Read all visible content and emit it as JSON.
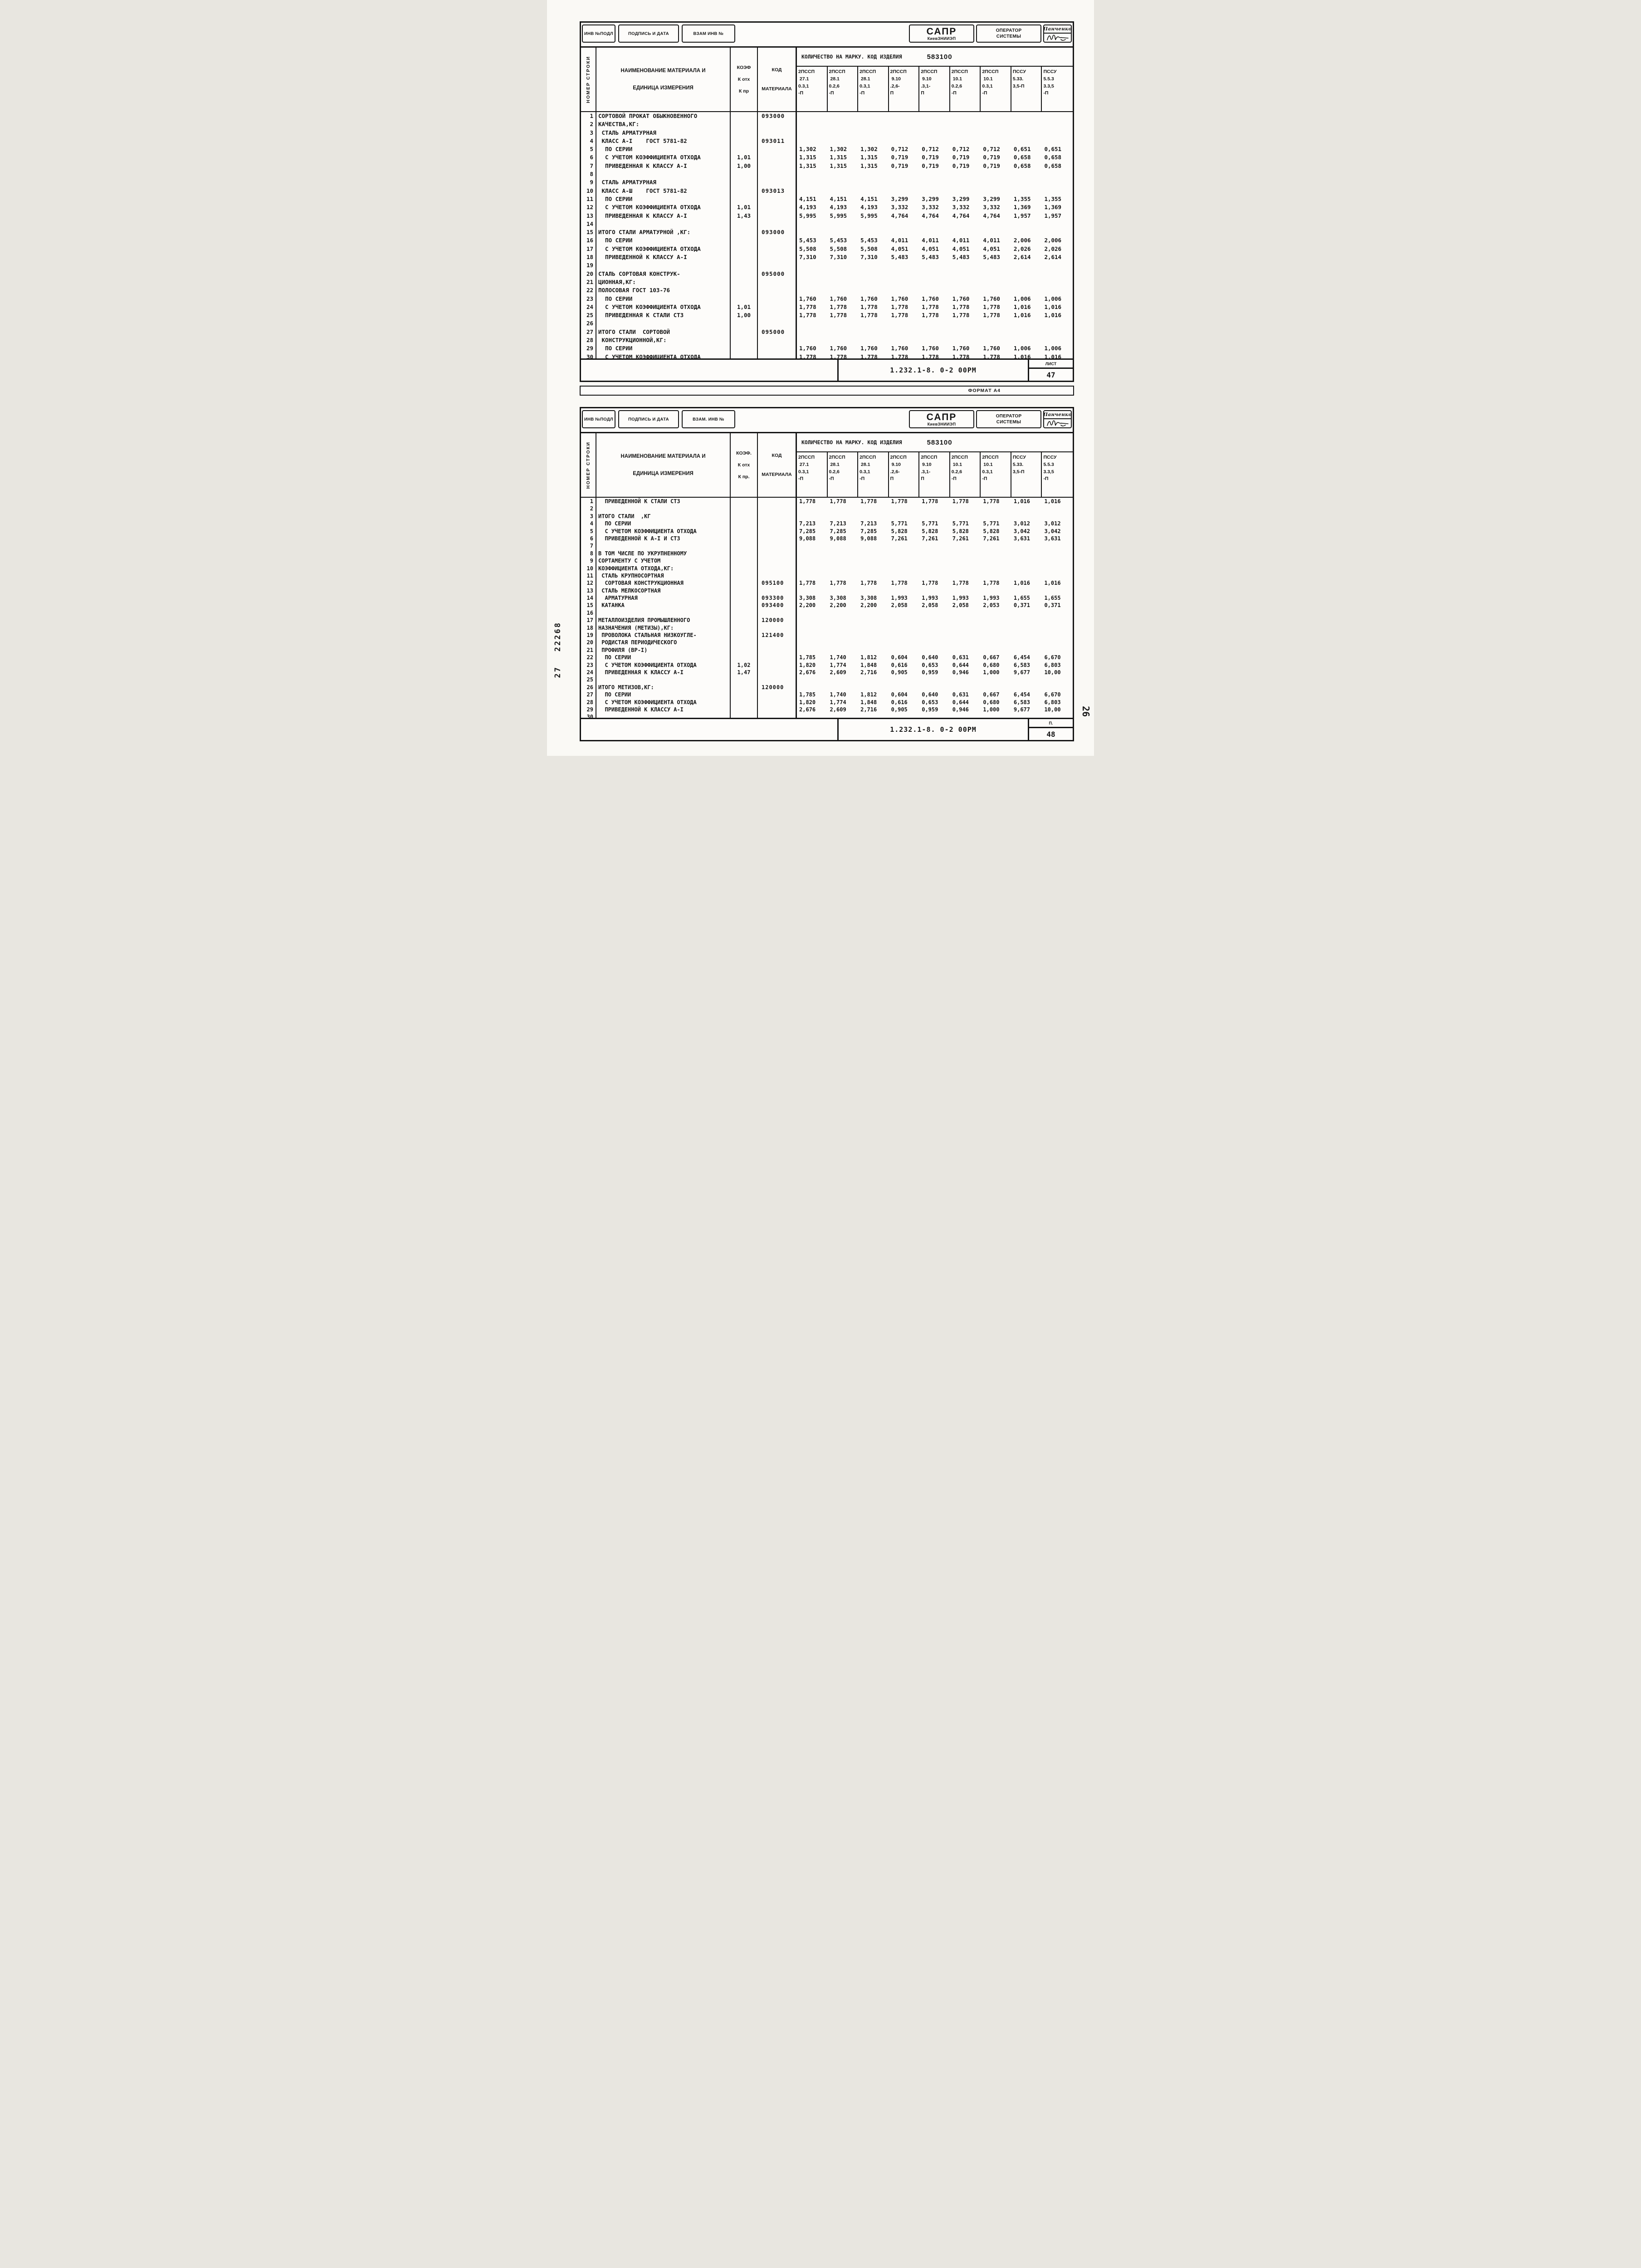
{
  "page": {
    "format_label": "ФОРМАТ А4",
    "margin_left_top": "22268",
    "margin_left_bottom": "27",
    "side_page_number": "26"
  },
  "sheets": [
    {
      "stamp_left": [
        "ИНВ №ПОДЛ",
        "ПОДПИСЬ И ДАТА",
        "ВЗАМ ИНВ №"
      ],
      "org": "САПР",
      "org_sub": "КиевЗНИИЭП",
      "operator_line1": "ОПЕРАТОР",
      "operator_line2": "СИСТЕМЫ",
      "operator_name": "Панченко",
      "row_header_vertical": "НОМЕР СТРОКИ",
      "name_header_1": "НАИМЕНОВАНИЕ  МАТЕРИАЛА  И",
      "name_header_2": "ЕДИНИЦА ИЗМЕРЕНИЯ",
      "coef_header": "КОЭФ",
      "coef_sub1": "К отх",
      "coef_sub2": "К пр",
      "code_header_1": "КОД",
      "code_header_2": "МАТЕРИАЛА",
      "qty_header": "КОЛИЧЕСТВО НА МАРКУ. КОД ИЗДЕЛИЯ",
      "product_code": "583100",
      "columns": [
        [
          "2ПССП",
          " 27.1",
          "0.3,1",
          "-П"
        ],
        [
          "2ПССП",
          " 28.1",
          "0.2,6",
          "-П"
        ],
        [
          "2ПССП",
          " 28.1",
          "0.3,1",
          "-П"
        ],
        [
          "2ПССП",
          " 9.10",
          ".2,6-",
          "П"
        ],
        [
          "2ПССП",
          " 9.10",
          ".3,1-",
          "П"
        ],
        [
          "2ПССП",
          " 10.1",
          "0.2,6",
          "-П"
        ],
        [
          "2ПССП",
          " 10.1",
          "0.3,1",
          "-П"
        ],
        [
          "ПССУ",
          "5.33.",
          "3,5-П",
          ""
        ],
        [
          "ПССУ",
          "5.5.3",
          "3.3,5",
          "-П"
        ]
      ],
      "rows": [
        {
          "n": "1",
          "name": "СОРТОВОЙ ПРОКАТ ОБЫКНОВЕННОГО",
          "coef": "",
          "code": "093000",
          "v": []
        },
        {
          "n": "2",
          "name": "КАЧЕСТВА,КГ:",
          "coef": "",
          "code": "",
          "v": []
        },
        {
          "n": "3",
          "name": " СТАЛЬ АРМАТУРНАЯ",
          "coef": "",
          "code": "",
          "v": []
        },
        {
          "n": "4",
          "name": " КЛАСС А-I    ГОСТ 5781-82",
          "coef": "",
          "code": "093011",
          "v": []
        },
        {
          "n": "5",
          "name": "  ПО СЕРИИ",
          "coef": "",
          "code": "",
          "v": [
            "1,302",
            "1,302",
            "1,302",
            "0,712",
            "0,712",
            "0,712",
            "0,712",
            "0,651",
            "0,651"
          ]
        },
        {
          "n": "6",
          "name": "  С УЧЕТОМ КОЭФФИЦИЕНТА ОТХОДА",
          "coef": "1,01",
          "code": "",
          "v": [
            "1,315",
            "1,315",
            "1,315",
            "0,719",
            "0,719",
            "0,719",
            "0,719",
            "0,658",
            "0,658"
          ]
        },
        {
          "n": "7",
          "name": "  ПРИВЕДЕННАЯ К КЛАССУ А-I",
          "coef": "1,00",
          "code": "",
          "v": [
            "1,315",
            "1,315",
            "1,315",
            "0,719",
            "0,719",
            "0,719",
            "0,719",
            "0,658",
            "0,658"
          ]
        },
        {
          "n": "8",
          "name": "",
          "coef": "",
          "code": "",
          "v": []
        },
        {
          "n": "9",
          "name": " СТАЛЬ АРМАТУРНАЯ",
          "coef": "",
          "code": "",
          "v": []
        },
        {
          "n": "10",
          "name": " КЛАСС А-Ш    ГОСТ 5781-82",
          "coef": "",
          "code": "093013",
          "v": []
        },
        {
          "n": "11",
          "name": "  ПО СЕРИИ",
          "coef": "",
          "code": "",
          "v": [
            "4,151",
            "4,151",
            "4,151",
            "3,299",
            "3,299",
            "3,299",
            "3,299",
            "1,355",
            "1,355"
          ]
        },
        {
          "n": "12",
          "name": "  С УЧЕТОМ КОЭФФИЦИЕНТА ОТХОДА",
          "coef": "1,01",
          "code": "",
          "v": [
            "4,193",
            "4,193",
            "4,193",
            "3,332",
            "3,332",
            "3,332",
            "3,332",
            "1,369",
            "1,369"
          ]
        },
        {
          "n": "13",
          "name": "  ПРИВЕДЕННАЯ К КЛАССУ А-I",
          "coef": "1,43",
          "code": "",
          "v": [
            "5,995",
            "5,995",
            "5,995",
            "4,764",
            "4,764",
            "4,764",
            "4,764",
            "1,957",
            "1,957"
          ]
        },
        {
          "n": "14",
          "name": "",
          "coef": "",
          "code": "",
          "v": []
        },
        {
          "n": "15",
          "name": "ИТОГО СТАЛИ АРМАТУРНОЙ ,КГ:",
          "coef": "",
          "code": "093000",
          "v": []
        },
        {
          "n": "16",
          "name": "  ПО СЕРИИ",
          "coef": "",
          "code": "",
          "v": [
            "5,453",
            "5,453",
            "5,453",
            "4,011",
            "4,011",
            "4,011",
            "4,011",
            "2,006",
            "2,006"
          ]
        },
        {
          "n": "17",
          "name": "  С УЧЕТОМ КОЭФФИЦИЕНТА ОТХОДА",
          "coef": "",
          "code": "",
          "v": [
            "5,508",
            "5,508",
            "5,508",
            "4,051",
            "4,051",
            "4,051",
            "4,051",
            "2,026",
            "2,026"
          ]
        },
        {
          "n": "18",
          "name": "  ПРИВЕДЕННОЙ К КЛАССУ А-I",
          "coef": "",
          "code": "",
          "v": [
            "7,310",
            "7,310",
            "7,310",
            "5,483",
            "5,483",
            "5,483",
            "5,483",
            "2,614",
            "2,614"
          ]
        },
        {
          "n": "19",
          "name": "",
          "coef": "",
          "code": "",
          "v": []
        },
        {
          "n": "20",
          "name": "СТАЛЬ СОРТОВАЯ КОНСТРУК-",
          "coef": "",
          "code": "095000",
          "v": []
        },
        {
          "n": "21",
          "name": "ЦИОННАЯ,КГ:",
          "coef": "",
          "code": "",
          "v": []
        },
        {
          "n": "22",
          "name": "ПОЛОСОВАЯ ГОСТ 103-76",
          "coef": "",
          "code": "",
          "v": []
        },
        {
          "n": "23",
          "name": "  ПО СЕРИИ",
          "coef": "",
          "code": "",
          "v": [
            "1,760",
            "1,760",
            "1,760",
            "1,760",
            "1,760",
            "1,760",
            "1,760",
            "1,006",
            "1,006"
          ]
        },
        {
          "n": "24",
          "name": "  С УЧЕТОМ КОЭФФИЦИЕНТА ОТХОДА",
          "coef": "1,01",
          "code": "",
          "v": [
            "1,778",
            "1,778",
            "1,778",
            "1,778",
            "1,778",
            "1,778",
            "1,778",
            "1,016",
            "1,016"
          ]
        },
        {
          "n": "25",
          "name": "  ПРИВЕДЕННАЯ К СТАЛИ СТ3",
          "coef": "1,00",
          "code": "",
          "v": [
            "1,778",
            "1,778",
            "1,778",
            "1,778",
            "1,778",
            "1,778",
            "1,778",
            "1,016",
            "1,016"
          ]
        },
        {
          "n": "26",
          "name": "",
          "coef": "",
          "code": "",
          "v": []
        },
        {
          "n": "27",
          "name": "ИТОГО СТАЛИ  СОРТОВОЙ",
          "coef": "",
          "code": "095000",
          "v": []
        },
        {
          "n": "28",
          "name": " КОНСТРУКЦИОННОЙ,КГ:",
          "coef": "",
          "code": "",
          "v": []
        },
        {
          "n": "29",
          "name": "  ПО СЕРИИ",
          "coef": "",
          "code": "",
          "v": [
            "1,760",
            "1,760",
            "1,760",
            "1,760",
            "1,760",
            "1,760",
            "1,760",
            "1,006",
            "1,006"
          ]
        },
        {
          "n": "30",
          "name": "  С УЧЕТОМ КОЭФФИЦИЕНТА ОТХОДА",
          "coef": "",
          "code": "",
          "v": [
            "1,778",
            "1,778",
            "1,778",
            "1,778",
            "1,778",
            "1,778",
            "1,778",
            "1,016",
            "1,016"
          ]
        }
      ],
      "footer_doc": "1.232.1-8.  0-2 00РМ",
      "footer_sheet_label": "ЛИСТ",
      "footer_sheet_no": "47"
    },
    {
      "stamp_left": [
        "ИНВ №ПОДЛ",
        "ПОДПИСЬ И ДАТА",
        "ВЗАМ. ИНВ №"
      ],
      "org": "САПР",
      "org_sub": "КиевЗНИИЭП",
      "operator_line1": "ОПЕРАТОР",
      "operator_line2": "СИСТЕМЫ",
      "operator_name": "Панченко",
      "row_header_vertical": "НОМЕР СТРОКИ",
      "name_header_1": "НАИМЕНОВАНИЕ  МАТЕРИАЛА  И",
      "name_header_2": "ЕДИНИЦА ИЗМЕРЕНИЯ",
      "coef_header": "КОЭФ.",
      "coef_sub1": "К отх",
      "coef_sub2": "К пр.",
      "code_header_1": "КОД",
      "code_header_2": "МАТЕРИАЛА",
      "qty_header": "КОЛИЧЕСТВО НА МАРКУ. КОД ИЗДЕЛИЯ",
      "product_code": "583100",
      "columns": [
        [
          "2ПССП",
          " 27.1",
          "0.3,1",
          "-П"
        ],
        [
          "2ПССП",
          " 28.1",
          "0.2,6",
          "-П"
        ],
        [
          "2ПССП",
          " 28.1",
          "0.3,1",
          "-П"
        ],
        [
          "2ПССП",
          " 9.10",
          ".2,6-",
          "П"
        ],
        [
          "2ПССП",
          " 9.10",
          ".3,1-",
          "П"
        ],
        [
          "2ПССП",
          " 10.1",
          "0.2,6",
          "-П"
        ],
        [
          "2ПССП",
          " 10.1",
          "0.3,1",
          "-П"
        ],
        [
          "ПССУ",
          "5.33.",
          "3,5-П",
          ""
        ],
        [
          "ПССУ",
          "5.5.3",
          "3.3,5",
          "-П"
        ]
      ],
      "rows": [
        {
          "n": "1",
          "name": "  ПРИВЕДЕННОЙ К СТАЛИ СТ3",
          "coef": "",
          "code": "",
          "v": [
            "1,778",
            "1,778",
            "1,778",
            "1,778",
            "1,778",
            "1,778",
            "1,778",
            "1,016",
            "1,016"
          ]
        },
        {
          "n": "2",
          "name": "",
          "coef": "",
          "code": "",
          "v": []
        },
        {
          "n": "3",
          "name": "ИТОГО СТАЛИ  ,КГ",
          "coef": "",
          "code": "",
          "v": []
        },
        {
          "n": "4",
          "name": "  ПО СЕРИИ",
          "coef": "",
          "code": "",
          "v": [
            "7,213",
            "7,213",
            "7,213",
            "5,771",
            "5,771",
            "5,771",
            "5,771",
            "3,012",
            "3,012"
          ]
        },
        {
          "n": "5",
          "name": "  С УЧЕТОМ КОЭФФИЦИЕНТА ОТХОДА",
          "coef": "",
          "code": "",
          "v": [
            "7,285",
            "7,285",
            "7,285",
            "5,828",
            "5,828",
            "5,828",
            "5,828",
            "3,042",
            "3,042"
          ]
        },
        {
          "n": "6",
          "name": "  ПРИВЕДЕННОЙ К А-I И СТ3",
          "coef": "",
          "code": "",
          "v": [
            "9,088",
            "9,088",
            "9,088",
            "7,261",
            "7,261",
            "7,261",
            "7,261",
            "3,631",
            "3,631"
          ]
        },
        {
          "n": "7",
          "name": "",
          "coef": "",
          "code": "",
          "v": []
        },
        {
          "n": "8",
          "name": "В ТОМ ЧИСЛЕ ПО УКРУПНЕННОМУ",
          "coef": "",
          "code": "",
          "v": []
        },
        {
          "n": "9",
          "name": "СОРТАМЕНТУ С УЧЕТОМ",
          "coef": "",
          "code": "",
          "v": []
        },
        {
          "n": "10",
          "name": "КОЭФФИЦИЕНТА ОТХОДА,КГ:",
          "coef": "",
          "code": "",
          "v": []
        },
        {
          "n": "11",
          "name": " СТАЛЬ КРУПНОСОРТНАЯ",
          "coef": "",
          "code": "",
          "v": []
        },
        {
          "n": "12",
          "name": "  СОРТОВАЯ КОНСТРУКЦИОННАЯ",
          "coef": "",
          "code": "095100",
          "v": [
            "1,778",
            "1,778",
            "1,778",
            "1,778",
            "1,778",
            "1,778",
            "1,778",
            "1,016",
            "1,016"
          ]
        },
        {
          "n": "13",
          "name": " СТАЛЬ МЕЛКОСОРТНАЯ",
          "coef": "",
          "code": "",
          "v": []
        },
        {
          "n": "14",
          "name": "  АРМАТУРНАЯ",
          "coef": "",
          "code": "093300",
          "v": [
            "3,308",
            "3,308",
            "3,308",
            "1,993",
            "1,993",
            "1,993",
            "1,993",
            "1,655",
            "1,655"
          ]
        },
        {
          "n": "15",
          "name": " КАТАНКА",
          "coef": "",
          "code": "093400",
          "v": [
            "2,200",
            "2,200",
            "2,200",
            "2,058",
            "2,058",
            "2,058",
            "2,053",
            "0,371",
            "0,371"
          ]
        },
        {
          "n": "16",
          "name": "",
          "coef": "",
          "code": "",
          "v": []
        },
        {
          "n": "17",
          "name": "МЕТАЛЛОИЗДЕЛИЯ ПРОМЫШЛЕННОГО",
          "coef": "",
          "code": "120000",
          "v": []
        },
        {
          "n": "18",
          "name": "НАЗНАЧЕНИЯ (МЕТИЗЫ),КГ:",
          "coef": "",
          "code": "",
          "v": []
        },
        {
          "n": "19",
          "name": " ПРОВОЛОКА СТАЛЬНАЯ НИЗКОУГЛЕ-",
          "coef": "",
          "code": "121400",
          "v": []
        },
        {
          "n": "20",
          "name": " РОДИСТАЯ ПЕРИОДИЧЕСКОГО",
          "coef": "",
          "code": "",
          "v": []
        },
        {
          "n": "21",
          "name": " ПРОФИЛЯ (ВР-I)",
          "coef": "",
          "code": "",
          "v": []
        },
        {
          "n": "22",
          "name": "  ПО СЕРИИ",
          "coef": "",
          "code": "",
          "v": [
            "1,785",
            "1,740",
            "1,812",
            "0,604",
            "0,640",
            "0,631",
            "0,667",
            "6,454",
            "6,670"
          ]
        },
        {
          "n": "23",
          "name": "  С УЧЕТОМ КОЭФФИЦИЕНТА ОТХОДА",
          "coef": "1,02",
          "code": "",
          "v": [
            "1,820",
            "1,774",
            "1,848",
            "0,616",
            "0,653",
            "0,644",
            "0,680",
            "6,583",
            "6,803"
          ]
        },
        {
          "n": "24",
          "name": "  ПРИВЕДЕННАЯ К КЛАССУ А-I",
          "coef": "1,47",
          "code": "",
          "v": [
            "2,676",
            "2,609",
            "2,716",
            "0,905",
            "0,959",
            "0,946",
            "1,000",
            "9,677",
            "10,00"
          ]
        },
        {
          "n": "25",
          "name": "",
          "coef": "",
          "code": "",
          "v": []
        },
        {
          "n": "26",
          "name": "ИТОГО МЕТИЗОВ,КГ:",
          "coef": "",
          "code": "120000",
          "v": []
        },
        {
          "n": "27",
          "name": "  ПО СЕРИИ",
          "coef": "",
          "code": "",
          "v": [
            "1,785",
            "1,740",
            "1,812",
            "0,604",
            "0,640",
            "0,631",
            "0,667",
            "6,454",
            "6,670"
          ]
        },
        {
          "n": "28",
          "name": "  С УЧЕТОМ КОЭФФИЦИЕНТА ОТХОДА",
          "coef": "",
          "code": "",
          "v": [
            "1,820",
            "1,774",
            "1,848",
            "0,616",
            "0,653",
            "0,644",
            "0,680",
            "6,583",
            "6,803"
          ]
        },
        {
          "n": "29",
          "name": "  ПРИВЕДЕННОЙ К КЛАССУ А-I",
          "coef": "",
          "code": "",
          "v": [
            "2,676",
            "2,609",
            "2,716",
            "0,905",
            "0,959",
            "0,946",
            "1,000",
            "9,677",
            "10,00"
          ]
        },
        {
          "n": "30",
          "name": "",
          "coef": "",
          "code": "",
          "v": []
        }
      ],
      "footer_doc": "1.232.1-8.  0-2 00РМ",
      "footer_sheet_label": "П.",
      "footer_sheet_no": "48"
    }
  ]
}
